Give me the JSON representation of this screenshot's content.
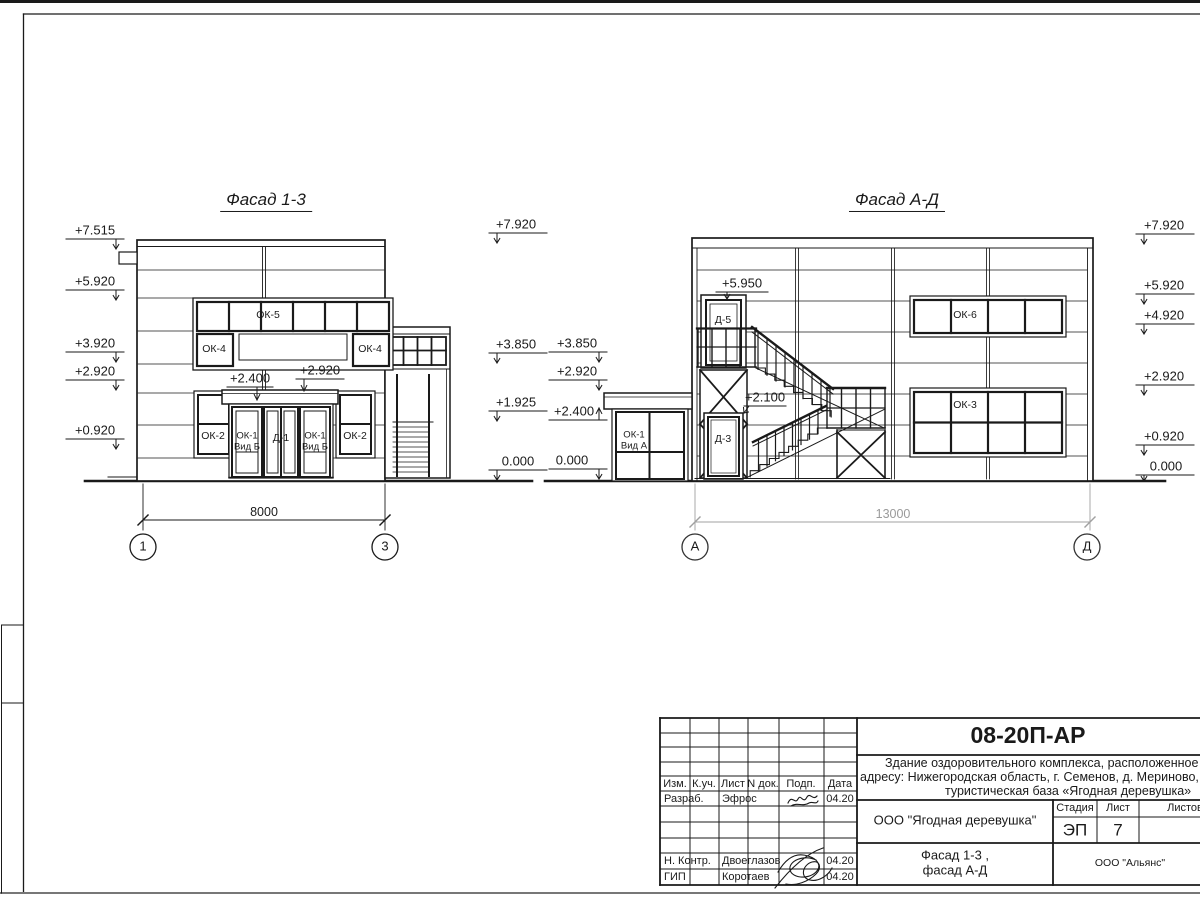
{
  "facade1": {
    "title": "Фасад 1-3",
    "marks_left": [
      "+7.515",
      "+5.920",
      "+3.920",
      "+2.920",
      "+0.920"
    ],
    "marks_right": [
      "+7.920",
      "+3.850",
      "+1.925",
      "0.000"
    ],
    "ann_canopy": "+2.400",
    "ann_canopy2": "+2.920",
    "labels": {
      "ok5": "ОК-5",
      "ok4l": "ОК-4",
      "ok4r": "ОК-4",
      "ok2l": "ОК-2",
      "ok2r": "ОК-2",
      "ok1l": "ОК-1\nВид Б",
      "d1": "Д-1",
      "ok1r": "ОК-1\nВид Б"
    },
    "dim": "8000",
    "axis_left": "1",
    "axis_right": "3"
  },
  "facade2": {
    "title": "Фасад А-Д",
    "marks_left": [
      "+3.850",
      "+2.920",
      "+2.400",
      "0.000"
    ],
    "marks_right": [
      "+7.920",
      "+5.920",
      "+4.920",
      "+2.920",
      "+0.920",
      "0.000"
    ],
    "ann_door_top": "+5.950",
    "ann_door_mid": "+2.100",
    "labels": {
      "d5": "Д-5",
      "d3": "Д-3",
      "ok1": "ОК-1\nВид А",
      "ok6": "ОК-6",
      "ok3": "ОК-3"
    },
    "dim": "13000",
    "axis_left": "А",
    "axis_right": "Д"
  },
  "titleblock": {
    "doc_code": "08-20П-АР",
    "doc_line1": "Здание оздоровительного комплекса, расположенное по",
    "doc_line2": "адресу: Нижегородская область, г. Семенов, д. Мериново,",
    "doc_line3": "туристическая база «Ягодная деревушка»",
    "headers": [
      "Изм.",
      "К.уч.",
      "Лист",
      "N док.",
      "Подп.",
      "Дата"
    ],
    "row_razrab": {
      "role": "Разраб.",
      "name": "Эфрос",
      "date": "04.20"
    },
    "row_nkontr": {
      "role": "Н. Контр.",
      "name": "Двоеглазов",
      "date": "04.20"
    },
    "row_gip": {
      "role": "ГИП",
      "name": "Коротаев",
      "date": "04.20"
    },
    "org": "ООО \"Ягодная деревушка\"",
    "sheet_title": "Фасад 1-3 ,\nфасад А-Д",
    "stage_header": "Стадия",
    "sheet_header": "Лист",
    "sheets_header": "Листов",
    "stage": "ЭП",
    "sheet_no": "7",
    "company": "ООО \"Альянс\""
  }
}
